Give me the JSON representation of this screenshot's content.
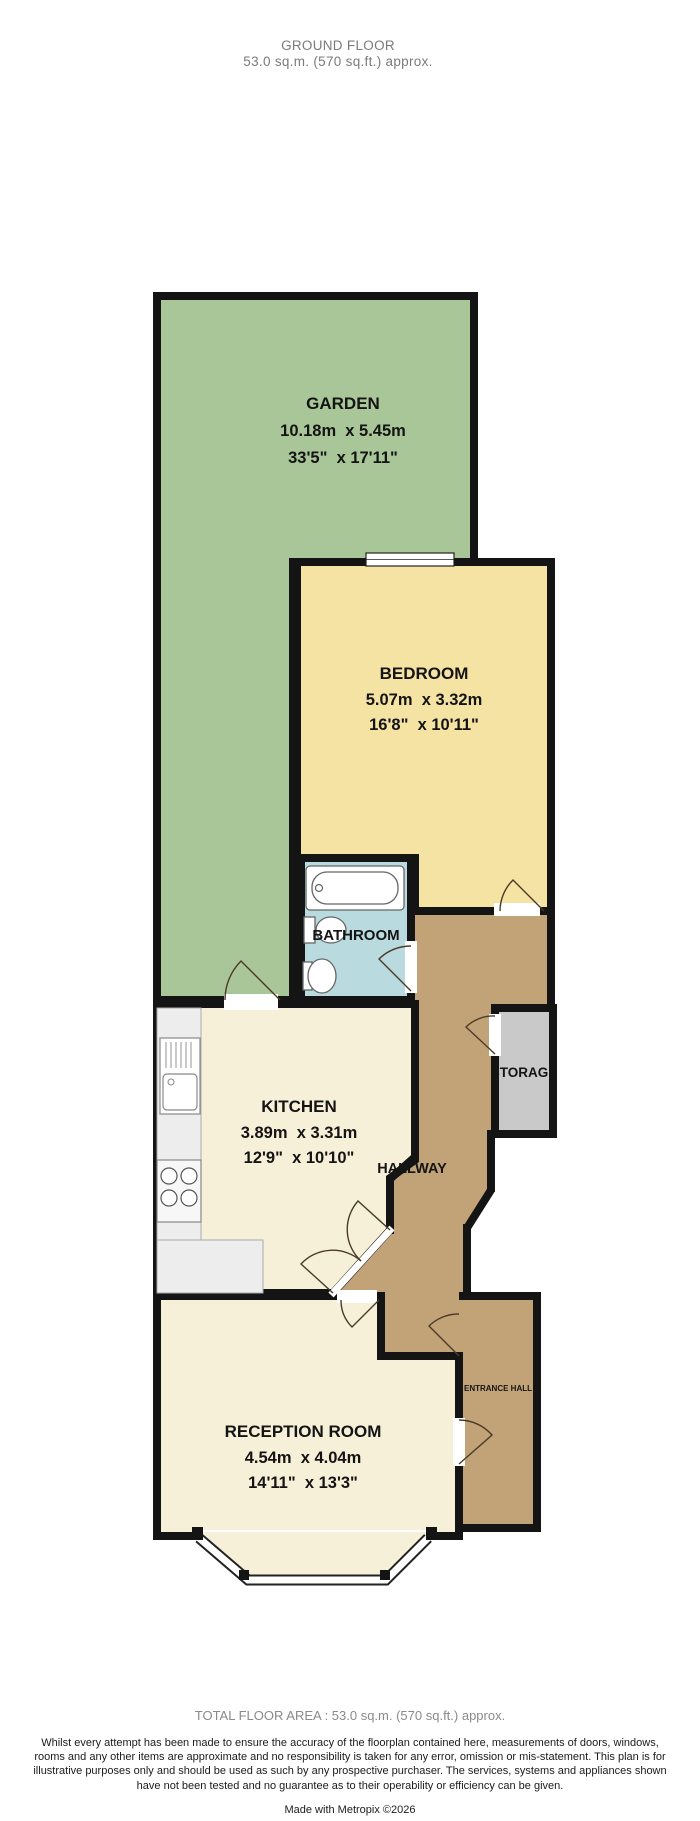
{
  "header": {
    "title": "GROUND FLOOR",
    "area": "53.0 sq.m. (570 sq.ft.) approx."
  },
  "rooms": {
    "garden": {
      "label": "GARDEN",
      "metric": "10.18m  x 5.45m",
      "imperial": "33'5\"  x 17'11\""
    },
    "bedroom": {
      "label": "BEDROOM",
      "metric": "5.07m  x 3.32m",
      "imperial": "16'8\"  x 10'11\""
    },
    "bathroom": {
      "label": "BATHROOM"
    },
    "storage": {
      "label": "STORAGE"
    },
    "hallway": {
      "label": "HALLWAY"
    },
    "kitchen": {
      "label": "KITCHEN",
      "metric": "3.89m  x 3.31m",
      "imperial": "12'9\"  x 10'10\""
    },
    "entrance_hall": {
      "label": "ENTRANCE HALL"
    },
    "reception": {
      "label": "RECEPTION ROOM",
      "metric": "4.54m  x 4.04m",
      "imperial": "14'11\"  x 13'3\""
    }
  },
  "colors": {
    "garden": "#a9c698",
    "bedroom": "#f5e3a4",
    "bathroom": "#b9dade",
    "kitchen": "#f7f0d9",
    "reception": "#f7f0d9",
    "hallway": "#c2a378",
    "entrance_hall": "#c2a378",
    "storage": "#c9c9c9",
    "wall": "#141414"
  },
  "footer": {
    "total": "TOTAL FLOOR AREA : 53.0 sq.m. (570 sq.ft.) approx.",
    "disclaimer": "Whilst every attempt has been made to ensure the accuracy of the floorplan contained here, measurements of doors, windows, rooms and any other items are approximate and no responsibility is taken for any error, omission or mis-statement. This plan is for illustrative purposes only and should be used as such by any prospective purchaser. The services, systems and appliances shown have not been tested and no guarantee as to their operability or efficiency can be given.",
    "credit": "Made with Metropix ©2026"
  }
}
